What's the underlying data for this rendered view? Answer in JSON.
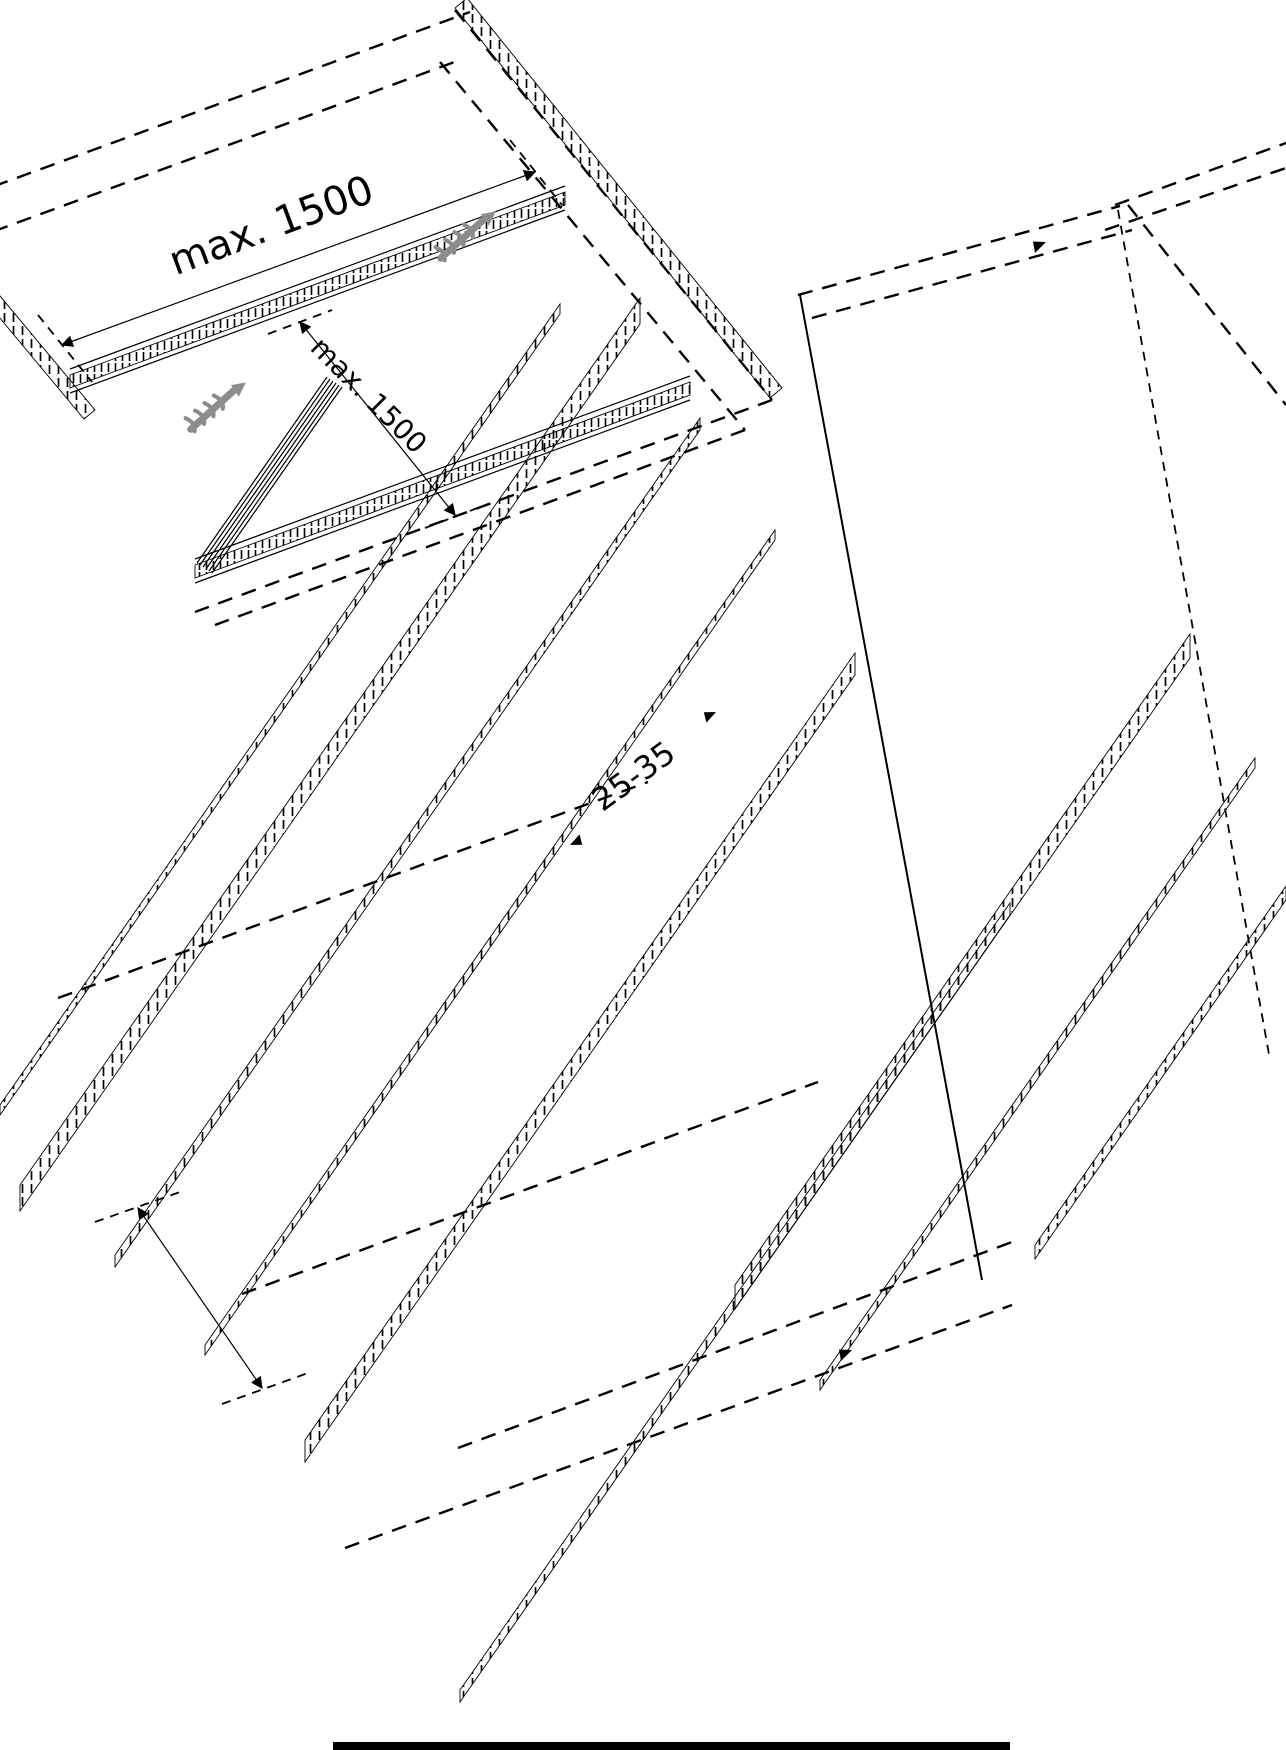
{
  "meta": {
    "description": "Black-and-white isometric technical installation drawing of large panels mounted on spaced support rails",
    "background_color": "#ffffff",
    "line_color": "#000000",
    "screw_icon_color": "#8c8c8c"
  },
  "labels": {
    "rail_spacing_top": "max. 1500",
    "rail_spacing_side": "max. 1500",
    "edge_distance": "25-35"
  }
}
